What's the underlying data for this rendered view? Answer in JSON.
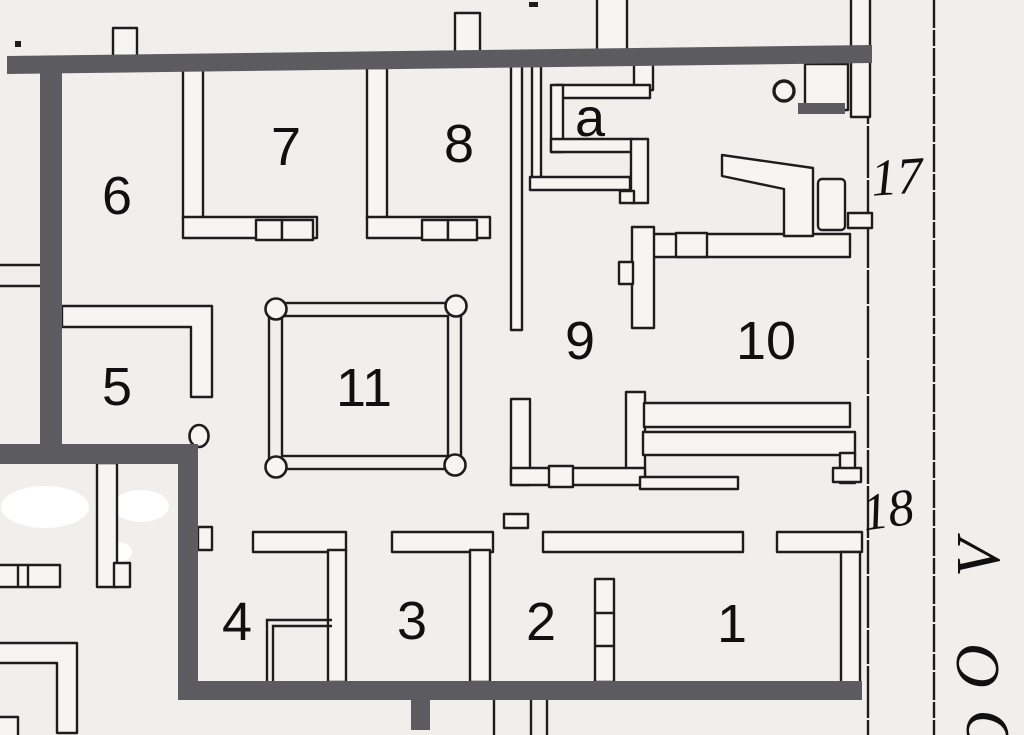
{
  "labels": {
    "rooms": {
      "r6": "6",
      "r7": "7",
      "r8": "8",
      "ra": "a",
      "r9": "9",
      "r10": "10",
      "r5": "5",
      "r11": "11",
      "r4": "4",
      "r3": "3",
      "r2": "2",
      "r1": "1"
    },
    "entrances": {
      "e17": "17",
      "e18": "18"
    },
    "street": {
      "l1": "V",
      "l2": "O",
      "l3": "O"
    }
  },
  "colors": {
    "paper": "#f0efec",
    "wall_thick": "#5c5c60",
    "line": "#1d1d1d",
    "wall_fill": "#f6f5f2",
    "patch": "#ffffff"
  }
}
